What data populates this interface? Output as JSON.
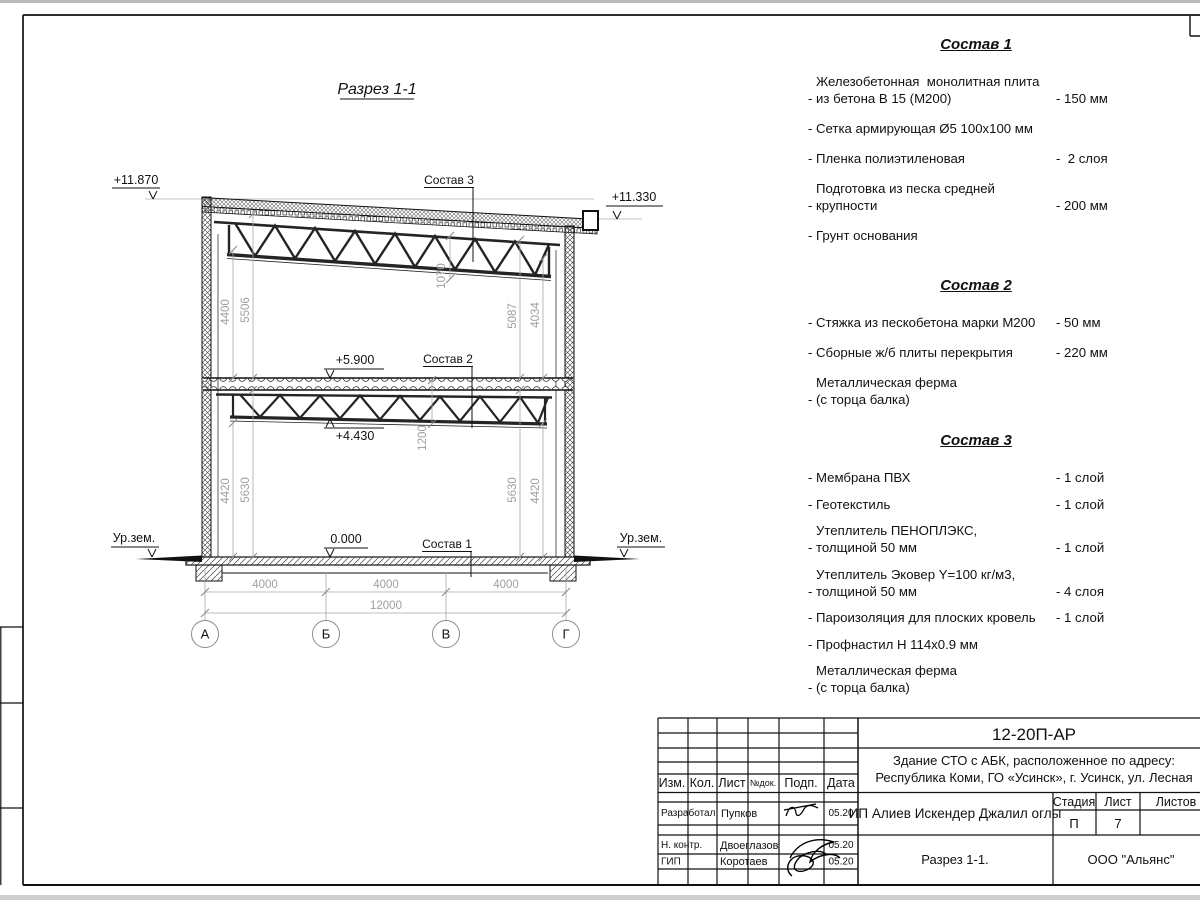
{
  "drawing": {
    "section_title": "Разрез 1-1",
    "elevations": {
      "roof_left": "+11.870",
      "roof_right": "+11.330",
      "floor2": "+5.900",
      "truss2": "+4.430",
      "floor0": "0.000"
    },
    "ground_level_label": "Ур.зем.",
    "callouts": {
      "c3": "Состав 3",
      "c2": "Состав 2",
      "c1": "Состав 1"
    },
    "dims": {
      "v_4400": "4400",
      "v_5506": "5506",
      "v_1070": "1070",
      "v_5087": "5087",
      "v_4034": "4034",
      "v_4420l": "4420",
      "v_5630l": "5630",
      "v_1200": "1200",
      "v_5630r": "5630",
      "v_4420r": "4420",
      "h_span1": "4000",
      "h_span2": "4000",
      "h_span3": "4000",
      "h_total": "12000"
    },
    "axes": [
      "А",
      "Б",
      "В",
      "Г"
    ]
  },
  "specs": [
    {
      "title": "Состав 1",
      "items": [
        {
          "text": "Железобетонная  монолитная плита\nиз бетона В 15 (М200)",
          "value": "- 150 мм"
        },
        {
          "text": "Сетка армирующая Ø5 100х100 мм",
          "value": ""
        },
        {
          "text": "Пленка полиэтиленовая",
          "value": "-  2 слоя"
        },
        {
          "text": "Подготовка из песка средней\nкрупности",
          "value": "- 200 мм"
        },
        {
          "text": "Грунт основания",
          "value": ""
        }
      ]
    },
    {
      "title": "Состав 2",
      "items": [
        {
          "text": "Стяжка из пескобетона марки М200",
          "value": "- 50 мм"
        },
        {
          "text": "Сборные ж/б плиты перекрытия",
          "value": "- 220 мм"
        },
        {
          "text": "Металлическая ферма\n(с торца балка)",
          "value": ""
        }
      ]
    },
    {
      "title": "Состав 3",
      "items": [
        {
          "text": "Мембрана ПВХ",
          "value": "- 1 слой"
        },
        {
          "text": "Геотекстиль",
          "value": "- 1 слой"
        },
        {
          "text": "Утеплитель ПЕНОПЛЭКС,\nтолщиной 50 мм",
          "value": "- 1 слой"
        },
        {
          "text": "Утеплитель Эковер Y=100 кг/м3,\nтолщиной 50 мм",
          "value": "- 4 слоя"
        },
        {
          "text": "Пароизоляция для плоских кровель",
          "value": "- 1 слой"
        },
        {
          "text": "Профнастил Н 114х0.9 мм",
          "value": ""
        },
        {
          "text": "Металлическая ферма\n(с торца балка)",
          "value": ""
        }
      ]
    }
  ],
  "titleblock": {
    "doc_code": "12-20П-АР",
    "project_line1": "Здание СТО с АБК, расположенное по адресу:",
    "project_line2": "Республика Коми, ГО «Усинск», г. Усинск, ул. Лесная",
    "client": "ИП Алиев Искендер Джалил оглы",
    "sheet_title": "Разрез 1-1.",
    "company": "ООО \"Альянс\"",
    "stage_label": "Стадия",
    "sheet_label": "Лист",
    "sheets_label": "Листов",
    "stage": "П",
    "sheet_no": "7",
    "col_izm": "Изм.",
    "col_kol": "Кол.",
    "col_list": "Лист",
    "col_ndoc": "№док.",
    "col_podp": "Подп.",
    "col_data": "Дата",
    "rows": [
      {
        "role": "Разработал",
        "name": "Пупков",
        "date": "05.20"
      },
      {
        "role": "Н. контр.",
        "name": "Двоеглазов",
        "date": "05.20"
      },
      {
        "role": "ГИП",
        "name": "Коротаев",
        "date": "05.20"
      }
    ]
  }
}
